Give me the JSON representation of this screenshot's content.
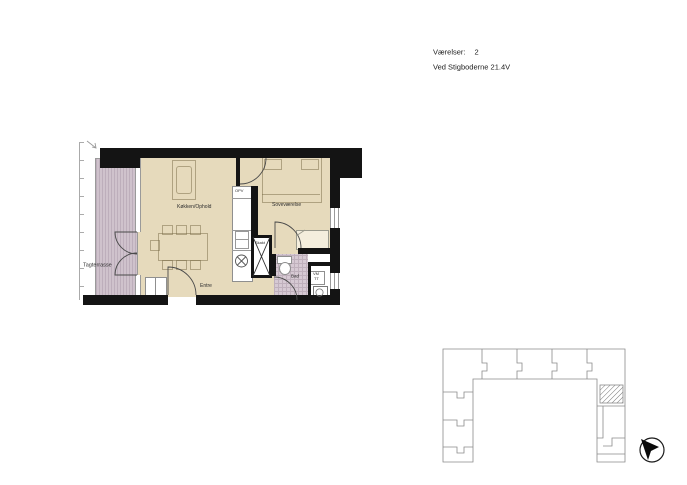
{
  "header": {
    "rooms_label": "Værelser:",
    "rooms_value": "2",
    "address": "Ved Stigboderne 21.4V"
  },
  "floor_plan": {
    "labels": {
      "terrace": "Tagterrasse",
      "kitchen_living": "Køkken/Ophold",
      "bedroom": "Soveværelse",
      "entrance": "Entre",
      "bathroom": "Bad",
      "shaft": "Skakt",
      "water_heater": "OPV",
      "washer": "VM",
      "dryer": "TT"
    },
    "colors": {
      "floor": "#e6dabc",
      "terrace": "#cfc2cc",
      "bathroom_tile": "#d6c9d3",
      "wall": "#141414",
      "line": "#8a8a8a"
    }
  },
  "icons": {
    "compass": "north-arrow-icon",
    "stove": "stove-burner-icon",
    "washing_machine": "washing-machine-icon"
  }
}
